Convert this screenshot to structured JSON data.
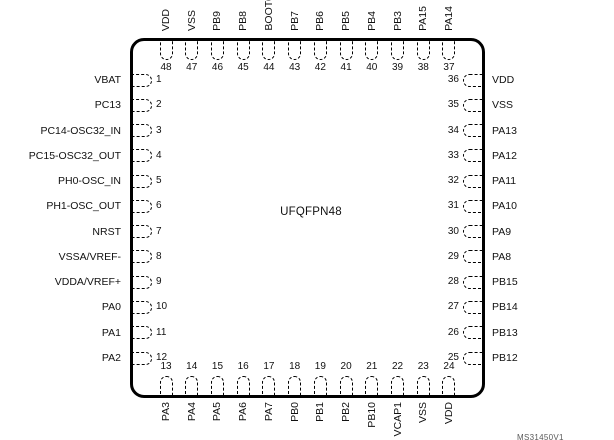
{
  "package": {
    "name": "UFQFPN48",
    "figure_id": "MS31450V1"
  },
  "colors": {
    "line": "#000000",
    "text": "#111111",
    "figure_id_text": "#595959",
    "background": "#ffffff"
  },
  "pins": {
    "top": [
      {
        "num": "48",
        "label": "VDD"
      },
      {
        "num": "47",
        "label": "VSS"
      },
      {
        "num": "46",
        "label": "PB9"
      },
      {
        "num": "45",
        "label": "PB8"
      },
      {
        "num": "44",
        "label": "BOOT0"
      },
      {
        "num": "43",
        "label": "PB7"
      },
      {
        "num": "42",
        "label": "PB6"
      },
      {
        "num": "41",
        "label": "PB5"
      },
      {
        "num": "40",
        "label": "PB4"
      },
      {
        "num": "39",
        "label": "PB3"
      },
      {
        "num": "38",
        "label": "PA15"
      },
      {
        "num": "37",
        "label": "PA14"
      }
    ],
    "left": [
      {
        "num": "1",
        "label": "VBAT"
      },
      {
        "num": "2",
        "label": "PC13"
      },
      {
        "num": "3",
        "label": "PC14-OSC32_IN"
      },
      {
        "num": "4",
        "label": "PC15-OSC32_OUT"
      },
      {
        "num": "5",
        "label": "PH0-OSC_IN"
      },
      {
        "num": "6",
        "label": "PH1-OSC_OUT"
      },
      {
        "num": "7",
        "label": "NRST"
      },
      {
        "num": "8",
        "label": "VSSA/VREF-"
      },
      {
        "num": "9",
        "label": "VDDA/VREF+"
      },
      {
        "num": "10",
        "label": "PA0"
      },
      {
        "num": "11",
        "label": "PA1"
      },
      {
        "num": "12",
        "label": "PA2"
      }
    ],
    "right": [
      {
        "num": "36",
        "label": "VDD"
      },
      {
        "num": "35",
        "label": "VSS"
      },
      {
        "num": "34",
        "label": "PA13"
      },
      {
        "num": "33",
        "label": "PA12"
      },
      {
        "num": "32",
        "label": "PA11"
      },
      {
        "num": "31",
        "label": "PA10"
      },
      {
        "num": "30",
        "label": "PA9"
      },
      {
        "num": "29",
        "label": "PA8"
      },
      {
        "num": "28",
        "label": "PB15"
      },
      {
        "num": "27",
        "label": "PB14"
      },
      {
        "num": "26",
        "label": "PB13"
      },
      {
        "num": "25",
        "label": "PB12"
      }
    ],
    "bottom": [
      {
        "num": "13",
        "label": "PA3"
      },
      {
        "num": "14",
        "label": "PA4"
      },
      {
        "num": "15",
        "label": "PA5"
      },
      {
        "num": "16",
        "label": "PA6"
      },
      {
        "num": "17",
        "label": "PA7"
      },
      {
        "num": "18",
        "label": "PB0"
      },
      {
        "num": "19",
        "label": "PB1"
      },
      {
        "num": "20",
        "label": "PB2"
      },
      {
        "num": "21",
        "label": "PB10"
      },
      {
        "num": "22",
        "label": "VCAP1"
      },
      {
        "num": "23",
        "label": "VSS"
      },
      {
        "num": "24",
        "label": "VDD"
      }
    ]
  }
}
